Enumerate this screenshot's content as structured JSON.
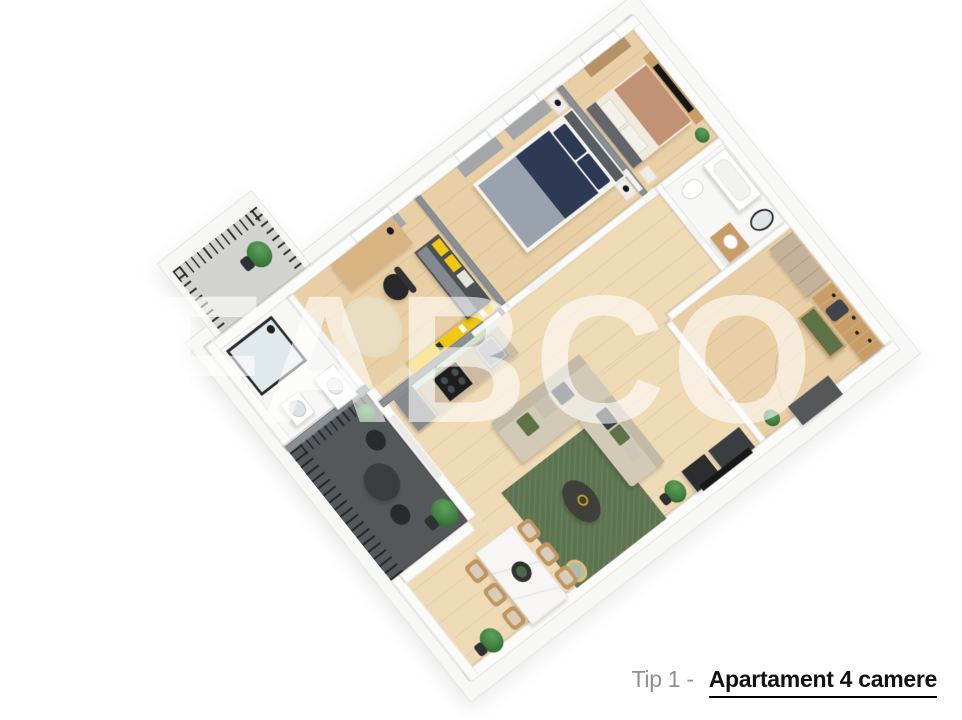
{
  "watermark": {
    "text": "FABCO"
  },
  "caption": {
    "prefix": "Tip 1 -",
    "title": "Apartament 4 camere"
  },
  "colors": {
    "wall-white": "#fbfbfa",
    "wall-gray": "#8a8f94",
    "slab": "#f7f7f6",
    "wood": "#e9cfa5",
    "wood-light": "#efdab6",
    "tile": "#e9e9e6",
    "tile2": "#efefec",
    "balcony-light": "#d3d4d2",
    "balcony-dark": "#55585b",
    "railing": "#212325",
    "navy": "#2e3a54",
    "blanket-gray": "#9aa3ad",
    "tan": "#c29275",
    "headboard": "#62666b",
    "sofa": "#d2cab6",
    "pillow-dark": "#3c4146",
    "pillow-green": "#5e7247",
    "rug-green": "#5d7450",
    "coffee-dark": "#3f3f3b",
    "gold": "#c9a227",
    "marble": "#f7f6f4",
    "chair-wood": "#c0955e",
    "cushion": "#d6cdbb",
    "wardrobe": "#c4b29a",
    "wood-panel": "#c89e66",
    "door-dark": "#54585b",
    "counter": "#cdbca2",
    "mint": "#cfe3cf",
    "steel": "#c2c7cb",
    "stove": "#1c1d1f",
    "unit-gray": "#85898d",
    "yellow": "#f2c713",
    "plant": "#3e7a3e",
    "desk-wood": "#d9b483",
    "chair-black": "#26282a",
    "curtain": "#9ba2a9",
    "watermark": "rgba(255,255,255,0.58)",
    "caption-gray": "#8f8f8f",
    "caption-black": "#111111"
  }
}
